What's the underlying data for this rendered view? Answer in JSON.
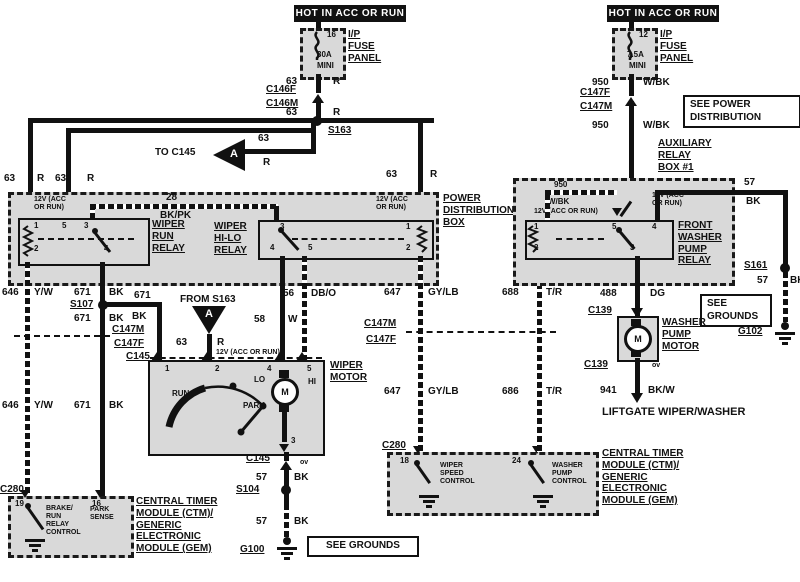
{
  "banners": {
    "left": "HOT IN ACC OR RUN",
    "right": "HOT IN ACC OR RUN"
  },
  "fuses": {
    "left": {
      "number": "16",
      "rating": "30A",
      "size": "MINI",
      "panel": "I/P\nFUSE\nPANEL"
    },
    "right": {
      "number": "12",
      "rating": "7.5A",
      "size": "MINI",
      "panel": "I/P\nFUSE\nPANEL"
    }
  },
  "wires": {
    "n63": "63",
    "r": "R",
    "n28": "28",
    "bkpk": "BK/PK",
    "n646": "646",
    "yw": "Y/W",
    "n671": "671",
    "bk": "BK",
    "n58": "58",
    "w": "W",
    "n56": "56",
    "dbo": "DB/O",
    "n57": "57",
    "n647": "647",
    "gylb": "GY/LB",
    "n688": "688",
    "n686": "686",
    "tr": "T/R",
    "n950": "950",
    "wbk": "W/BK",
    "n488": "488",
    "dg": "DG",
    "n941": "941",
    "bkw": "BK/W",
    "zero_volts": "ov"
  },
  "connectors": {
    "c146f": "C146F",
    "c146m": "C146M",
    "c147f": "C147F",
    "c147m": "C147M",
    "c145": "C145",
    "c280": "C280",
    "c139": "C139"
  },
  "splices": {
    "s163": "S163",
    "s107": "S107",
    "s104": "S104",
    "s161": "S161"
  },
  "grounds": {
    "g100": "G100",
    "g102": "G102"
  },
  "notes": {
    "see_power": "SEE POWER\nDISTRIBUTION",
    "see_grounds": "SEE GROUNDS",
    "see_grounds_stacked": "SEE\nGROUNDS",
    "to_c145": "TO C145",
    "from_s163": "FROM S163",
    "arrow_letter": "A",
    "v12_one_line": "12V (ACC OR RUN)",
    "v12_two_line": "12V (ACC\nOR RUN)",
    "liftgate": "LIFTGATE WIPER/WASHER"
  },
  "boxes": {
    "pdb": "POWER\nDISTRIBUTION\nBOX",
    "aux": "AUXILIARY\nRELAY\nBOX #1",
    "run_relay": "WIPER\nRUN\nRELAY",
    "hilo_relay": "WIPER\nHI-LO\nRELAY",
    "fwp_relay": "FRONT\nWASHER\nPUMP\nRELAY",
    "wiper_motor": "WIPER\nMOTOR",
    "washer_motor": "WASHER\nPUMP\nMOTOR",
    "ctm": "CENTRAL TIMER\nMODULE (CTM)/\nGENERIC\nELECTRONIC\nMODULE (GEM)"
  },
  "pins": {
    "p1": "1",
    "p2": "2",
    "p3": "3",
    "p4": "4",
    "p5": "5",
    "p16": "16",
    "p18": "18",
    "p19": "19",
    "p24": "24"
  },
  "internals": {
    "run": "RUN",
    "park": "PARK",
    "lo": "LO",
    "hi": "HI",
    "motor_m": "M",
    "brake_run": "BRAKE/\nRUN\nRELAY\nCONTROL",
    "park_sense": "PARK\nSENSE",
    "wiper_speed": "WIPER\nSPEED\nCONTROL",
    "washer_pump": "WASHER\nPUMP\nCONTROL"
  },
  "colors": {
    "line": "#111111",
    "shade": "#d9d9d9"
  }
}
